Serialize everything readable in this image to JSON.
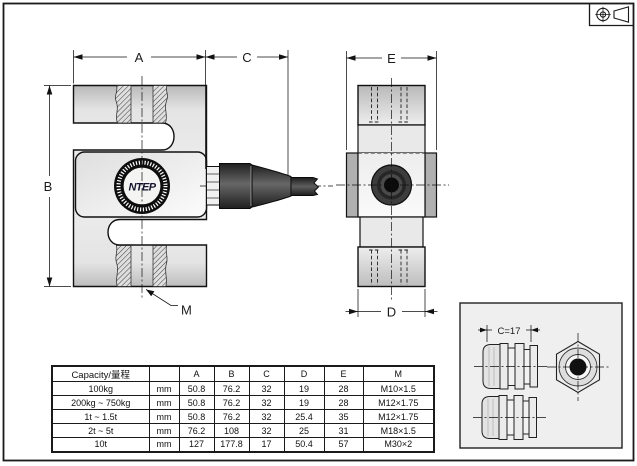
{
  "drawing": {
    "projection_symbol": "first-angle-projection-symbol",
    "logo_text": "NTEP",
    "dim_labels": {
      "A": "A",
      "B": "B",
      "C": "C",
      "D": "D",
      "E": "E",
      "M": "M"
    },
    "detail_dim_label": "C=17"
  },
  "table": {
    "headers": [
      "Capacity/量程",
      "",
      "A",
      "B",
      "C",
      "D",
      "E",
      "M"
    ],
    "rows": [
      [
        "100kg",
        "mm",
        "50.8",
        "76.2",
        "32",
        "19",
        "28",
        "M10×1.5"
      ],
      [
        "200kg ~ 750kg",
        "mm",
        "50.8",
        "76.2",
        "32",
        "19",
        "28",
        "M12×1.75"
      ],
      [
        "1t ~ 1.5t",
        "mm",
        "50.8",
        "76.2",
        "32",
        "25.4",
        "35",
        "M12×1.75"
      ],
      [
        "2t ~ 5t",
        "mm",
        "76.2",
        "108",
        "32",
        "25",
        "31",
        "M18×1.5"
      ],
      [
        "10t",
        "mm",
        "127",
        "177.8",
        "17",
        "50.4",
        "57",
        "M30×2"
      ]
    ]
  },
  "colors": {
    "line": "#1a1a1a",
    "metal_dark": "#bdbdbd",
    "metal_light": "#f0f0f0",
    "tab_gray": "#b0b0b0",
    "cable_dark": "#333333",
    "detail_bg": "#efefef",
    "page_bg": "#ffffff"
  }
}
